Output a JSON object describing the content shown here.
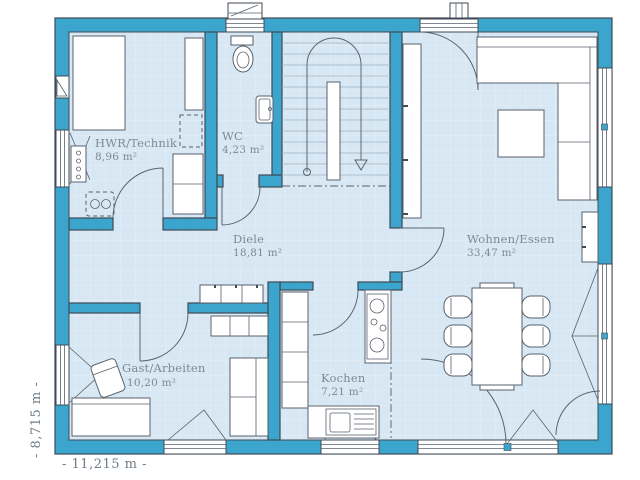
{
  "plan": {
    "rooms": [
      {
        "id": "hwr",
        "name": "HWR/Technik",
        "area": "8,96 m²"
      },
      {
        "id": "wc",
        "name": "WC",
        "area": "4,23 m²"
      },
      {
        "id": "diele",
        "name": "Diele",
        "area": "18,81 m²"
      },
      {
        "id": "wohnen",
        "name": "Wohnen/Essen",
        "area": "33,47 m²"
      },
      {
        "id": "gast",
        "name": "Gast/Arbeiten",
        "area": "10,20 m²"
      },
      {
        "id": "kochen",
        "name": "Kochen",
        "area": "7,21 m²"
      }
    ],
    "dimensions": {
      "width": "- 11,215 m -",
      "height": "- 8,715 m -"
    },
    "colors": {
      "wall": "#3BA5CD",
      "wall_outline": "#3F4A55",
      "floor": "#D7E8F4",
      "floor_grid": "#E7F1F9",
      "label_text": "#7D8A94",
      "dimension_text": "#6E7D88"
    }
  }
}
